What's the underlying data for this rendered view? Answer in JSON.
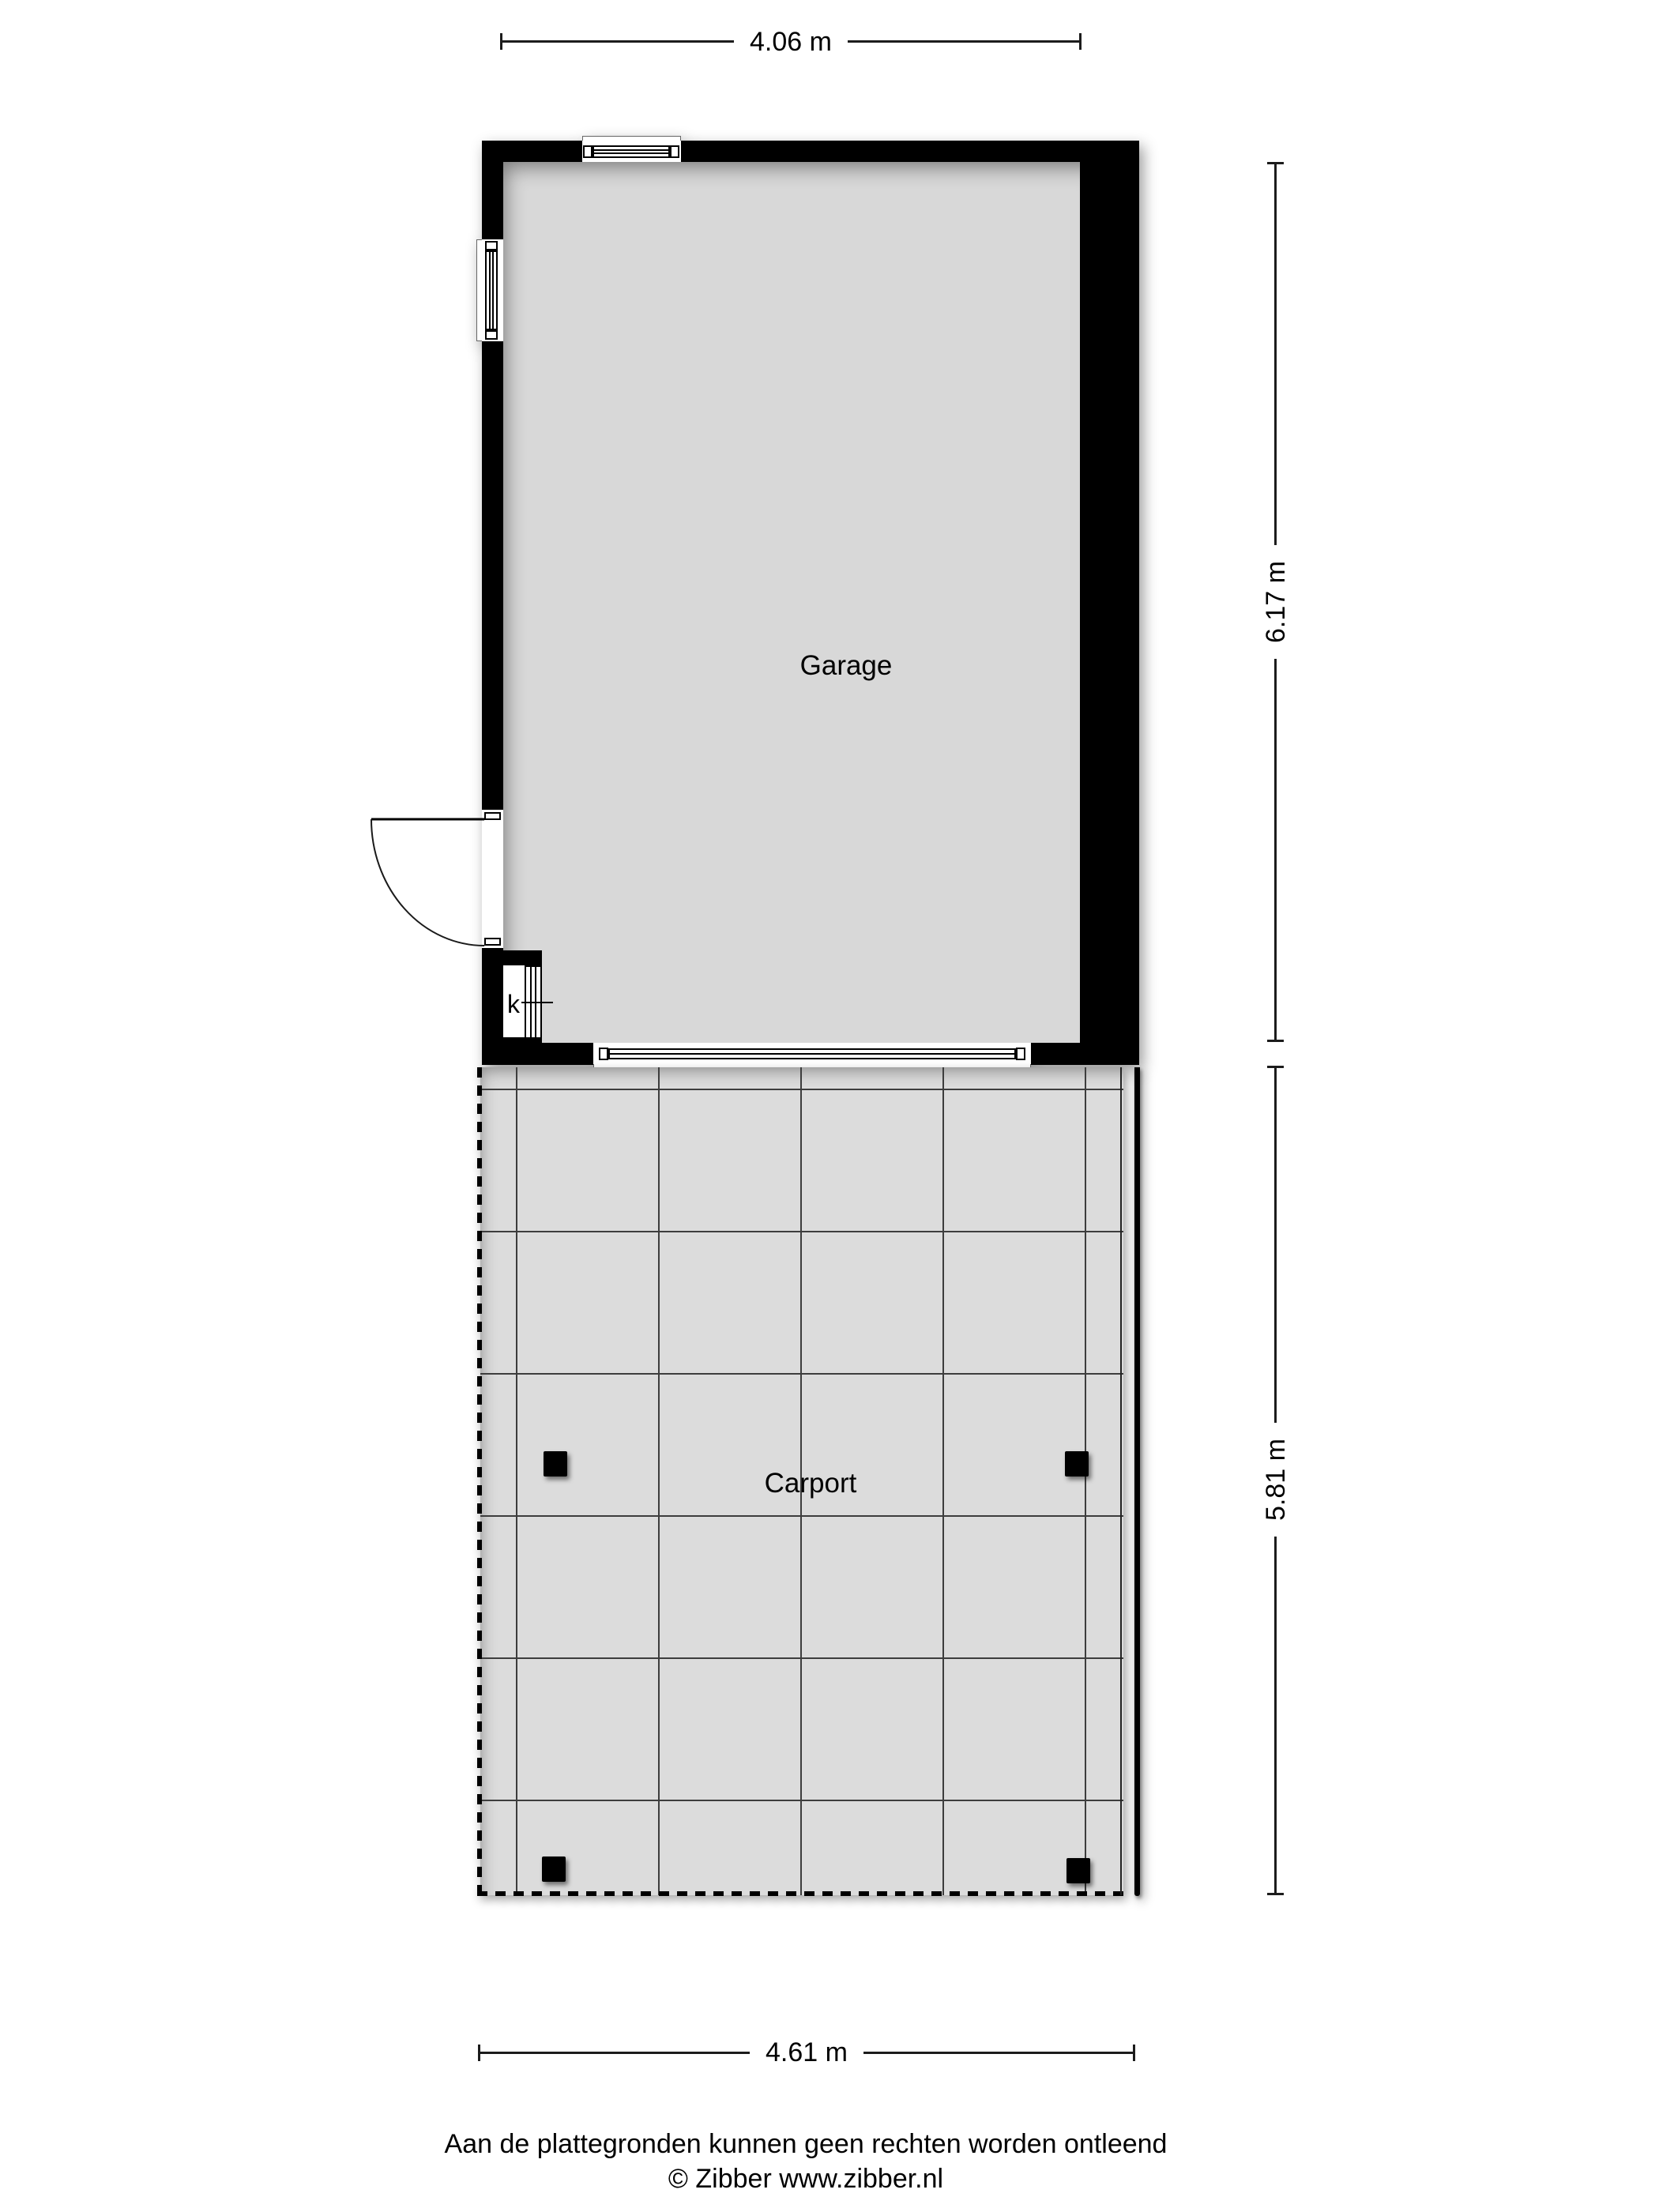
{
  "rooms": {
    "garage": {
      "label": "Garage"
    },
    "carport": {
      "label": "Carport"
    },
    "closet": {
      "label": "k"
    }
  },
  "dimensions": {
    "garage_width": "4.06 m",
    "garage_depth": "6.17 m",
    "carport_depth": "5.81 m",
    "carport_width": "4.61 m"
  },
  "footer": {
    "disclaimer": "Aan de plattegronden kunnen geen rechten worden ontleend",
    "credit": "© Zibber www.zibber.nl"
  },
  "colors": {
    "background": "#ffffff",
    "wall": "#000000",
    "garage_floor": "#d8d8d8",
    "carport_floor": "#dcdcdc",
    "grid_line": "#3d3d3d",
    "text": "#000000"
  }
}
